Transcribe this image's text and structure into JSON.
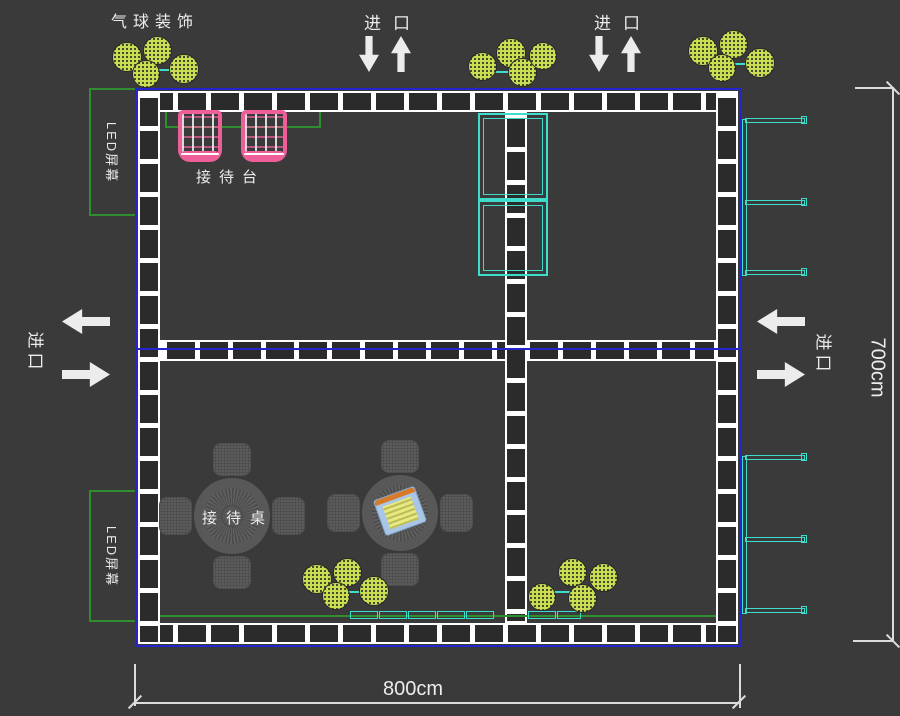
{
  "colors": {
    "background": "#3a3a3a",
    "booth_outline_blue": "#2525cd",
    "truss_white": "#ffffff",
    "balloon_green": "#c9dc52",
    "desk_pink": "#ee5f99",
    "shelf_cyan": "#3edccb",
    "led_green": "#2f8f2f",
    "dimension_white": "#dcdcdc",
    "furniture_gray": "#5c5c5c"
  },
  "labels": {
    "balloon_decoration": "气球装饰",
    "entrance": "进口",
    "reception_desk": "接待台",
    "reception_table": "接待桌",
    "led_screen": "LED屏幕"
  },
  "dimensions": {
    "width_label": "800cm",
    "height_label": "700cm"
  },
  "icons": {
    "down_arrow": "entrance-down-arrow",
    "up_arrow": "entrance-up-arrow",
    "left_arrow": "entrance-left-arrow",
    "right_arrow": "entrance-right-arrow",
    "balloon": "balloon-circle"
  },
  "furniture_counts": {
    "balloon_clusters": 5,
    "reception_desks": 2,
    "round_tables": 2,
    "chairs_per_table": 4,
    "side_wall_shelves": 2,
    "center_cabinets": 2,
    "low_cabinets": 7,
    "led_screens": 2,
    "entrances": 4
  }
}
